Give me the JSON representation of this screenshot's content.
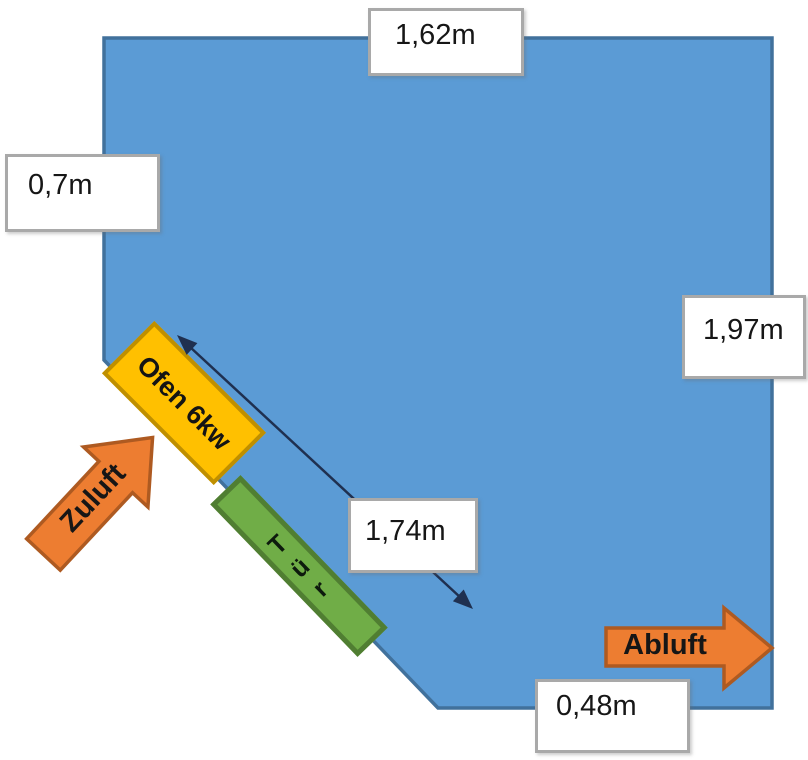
{
  "diagram": {
    "type": "room-floor-plan"
  },
  "colors": {
    "room_fill": "#5B9BD5",
    "room_border": "#41719C",
    "oven_fill": "#FFC000",
    "oven_border": "#BF8F00",
    "door_fill": "#70AD47",
    "door_border": "#507E32",
    "arrow_fill": "#ED7D31",
    "arrow_border": "#AE5A21",
    "dim_line": "#1F3050"
  },
  "dimensions": {
    "top": "1,62m",
    "left": "0,7m",
    "right": "1,97m",
    "diagonal": "1,74m",
    "bottom": "0,48m"
  },
  "shapes": {
    "oven_label": "Ofen 6kw",
    "door_label": "Tür",
    "door_letters": [
      "T",
      "ü",
      "r"
    ],
    "supply_air_label": "Zuluft",
    "exhaust_air_label": "Abluft"
  }
}
